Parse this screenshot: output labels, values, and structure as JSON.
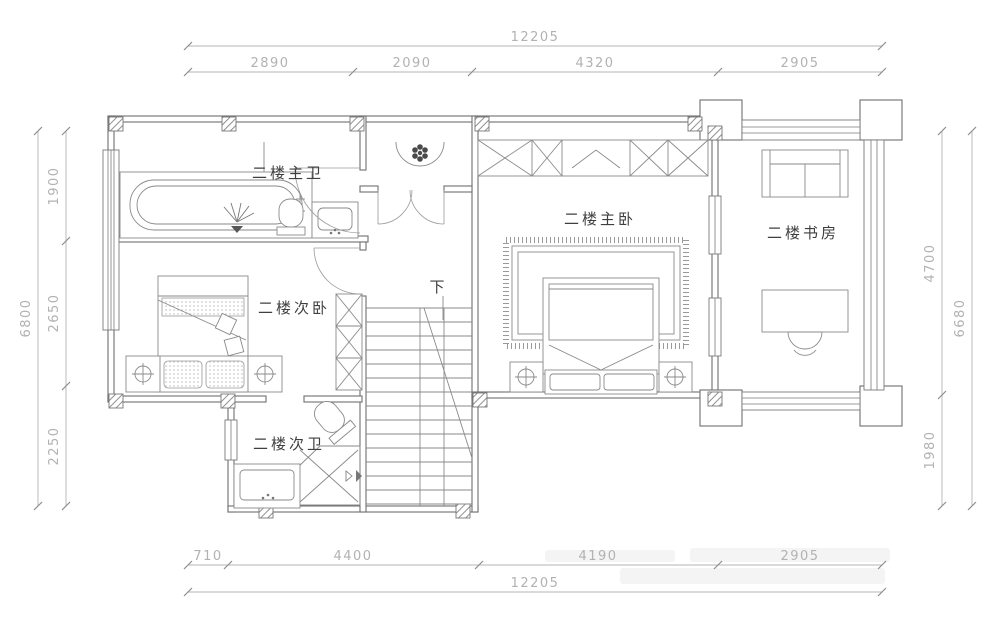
{
  "rooms": {
    "master_bath": "二楼主卫",
    "master_bedroom": "二楼主卧",
    "study": "二楼书房",
    "second_bedroom": "二楼次卧",
    "second_bath": "二楼次卫",
    "stair_direction": "下"
  },
  "dimensions": {
    "top": {
      "total": "12205",
      "segments": [
        "2890",
        "2090",
        "4320",
        "2905"
      ]
    },
    "bottom": {
      "total": "12205",
      "segments": [
        "710",
        "4400",
        "4190",
        "2905"
      ]
    },
    "left": {
      "total": "6800",
      "segments": [
        "1900",
        "2650",
        "2250"
      ]
    },
    "right": {
      "total": "6680",
      "segments": [
        "4700",
        "1980"
      ]
    }
  },
  "colors": {
    "wall_line": "#6e6e6e",
    "furniture_line": "#8a8a8a",
    "dimension": "#b2b2b2",
    "label": "#3f3f3f",
    "background": "#ffffff"
  }
}
